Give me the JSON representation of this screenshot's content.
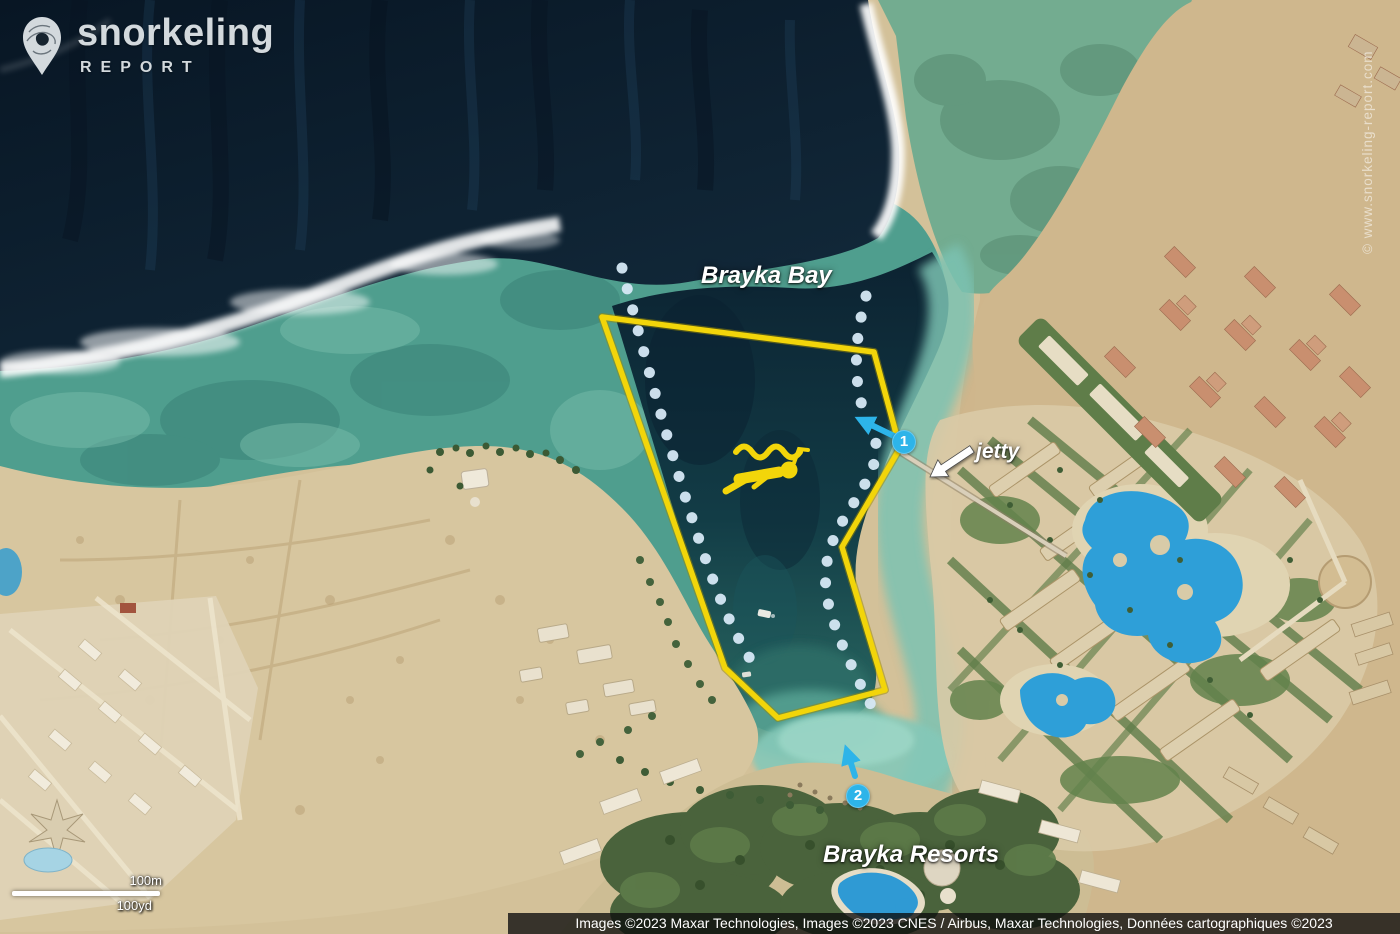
{
  "logo": {
    "title": "snorkeling",
    "subtitle": "REPORT"
  },
  "map": {
    "place_labels": [
      {
        "text": "Brayka Bay"
      },
      {
        "text": "jetty"
      },
      {
        "text": "Brayka Resorts"
      }
    ],
    "markers": [
      {
        "label": "1"
      },
      {
        "label": "2"
      }
    ]
  },
  "scale_bar": {
    "metric": "100m",
    "imperial": "100yd"
  },
  "watermark": "© www.snorkeling-report.com",
  "attribution": "Images ©2023 Maxar Technologies, Images ©2023 CNES / Airbus, Maxar Technologies, Données cartographiques ©2023",
  "colors": {
    "zone_outline": "#f2d50a",
    "marker": "#2db4e9",
    "route_dots": "#d6e8f5",
    "deep_ocean": "#0a1c2c",
    "reef_flat": "#4f9e8e",
    "sand": "#d3c199"
  }
}
